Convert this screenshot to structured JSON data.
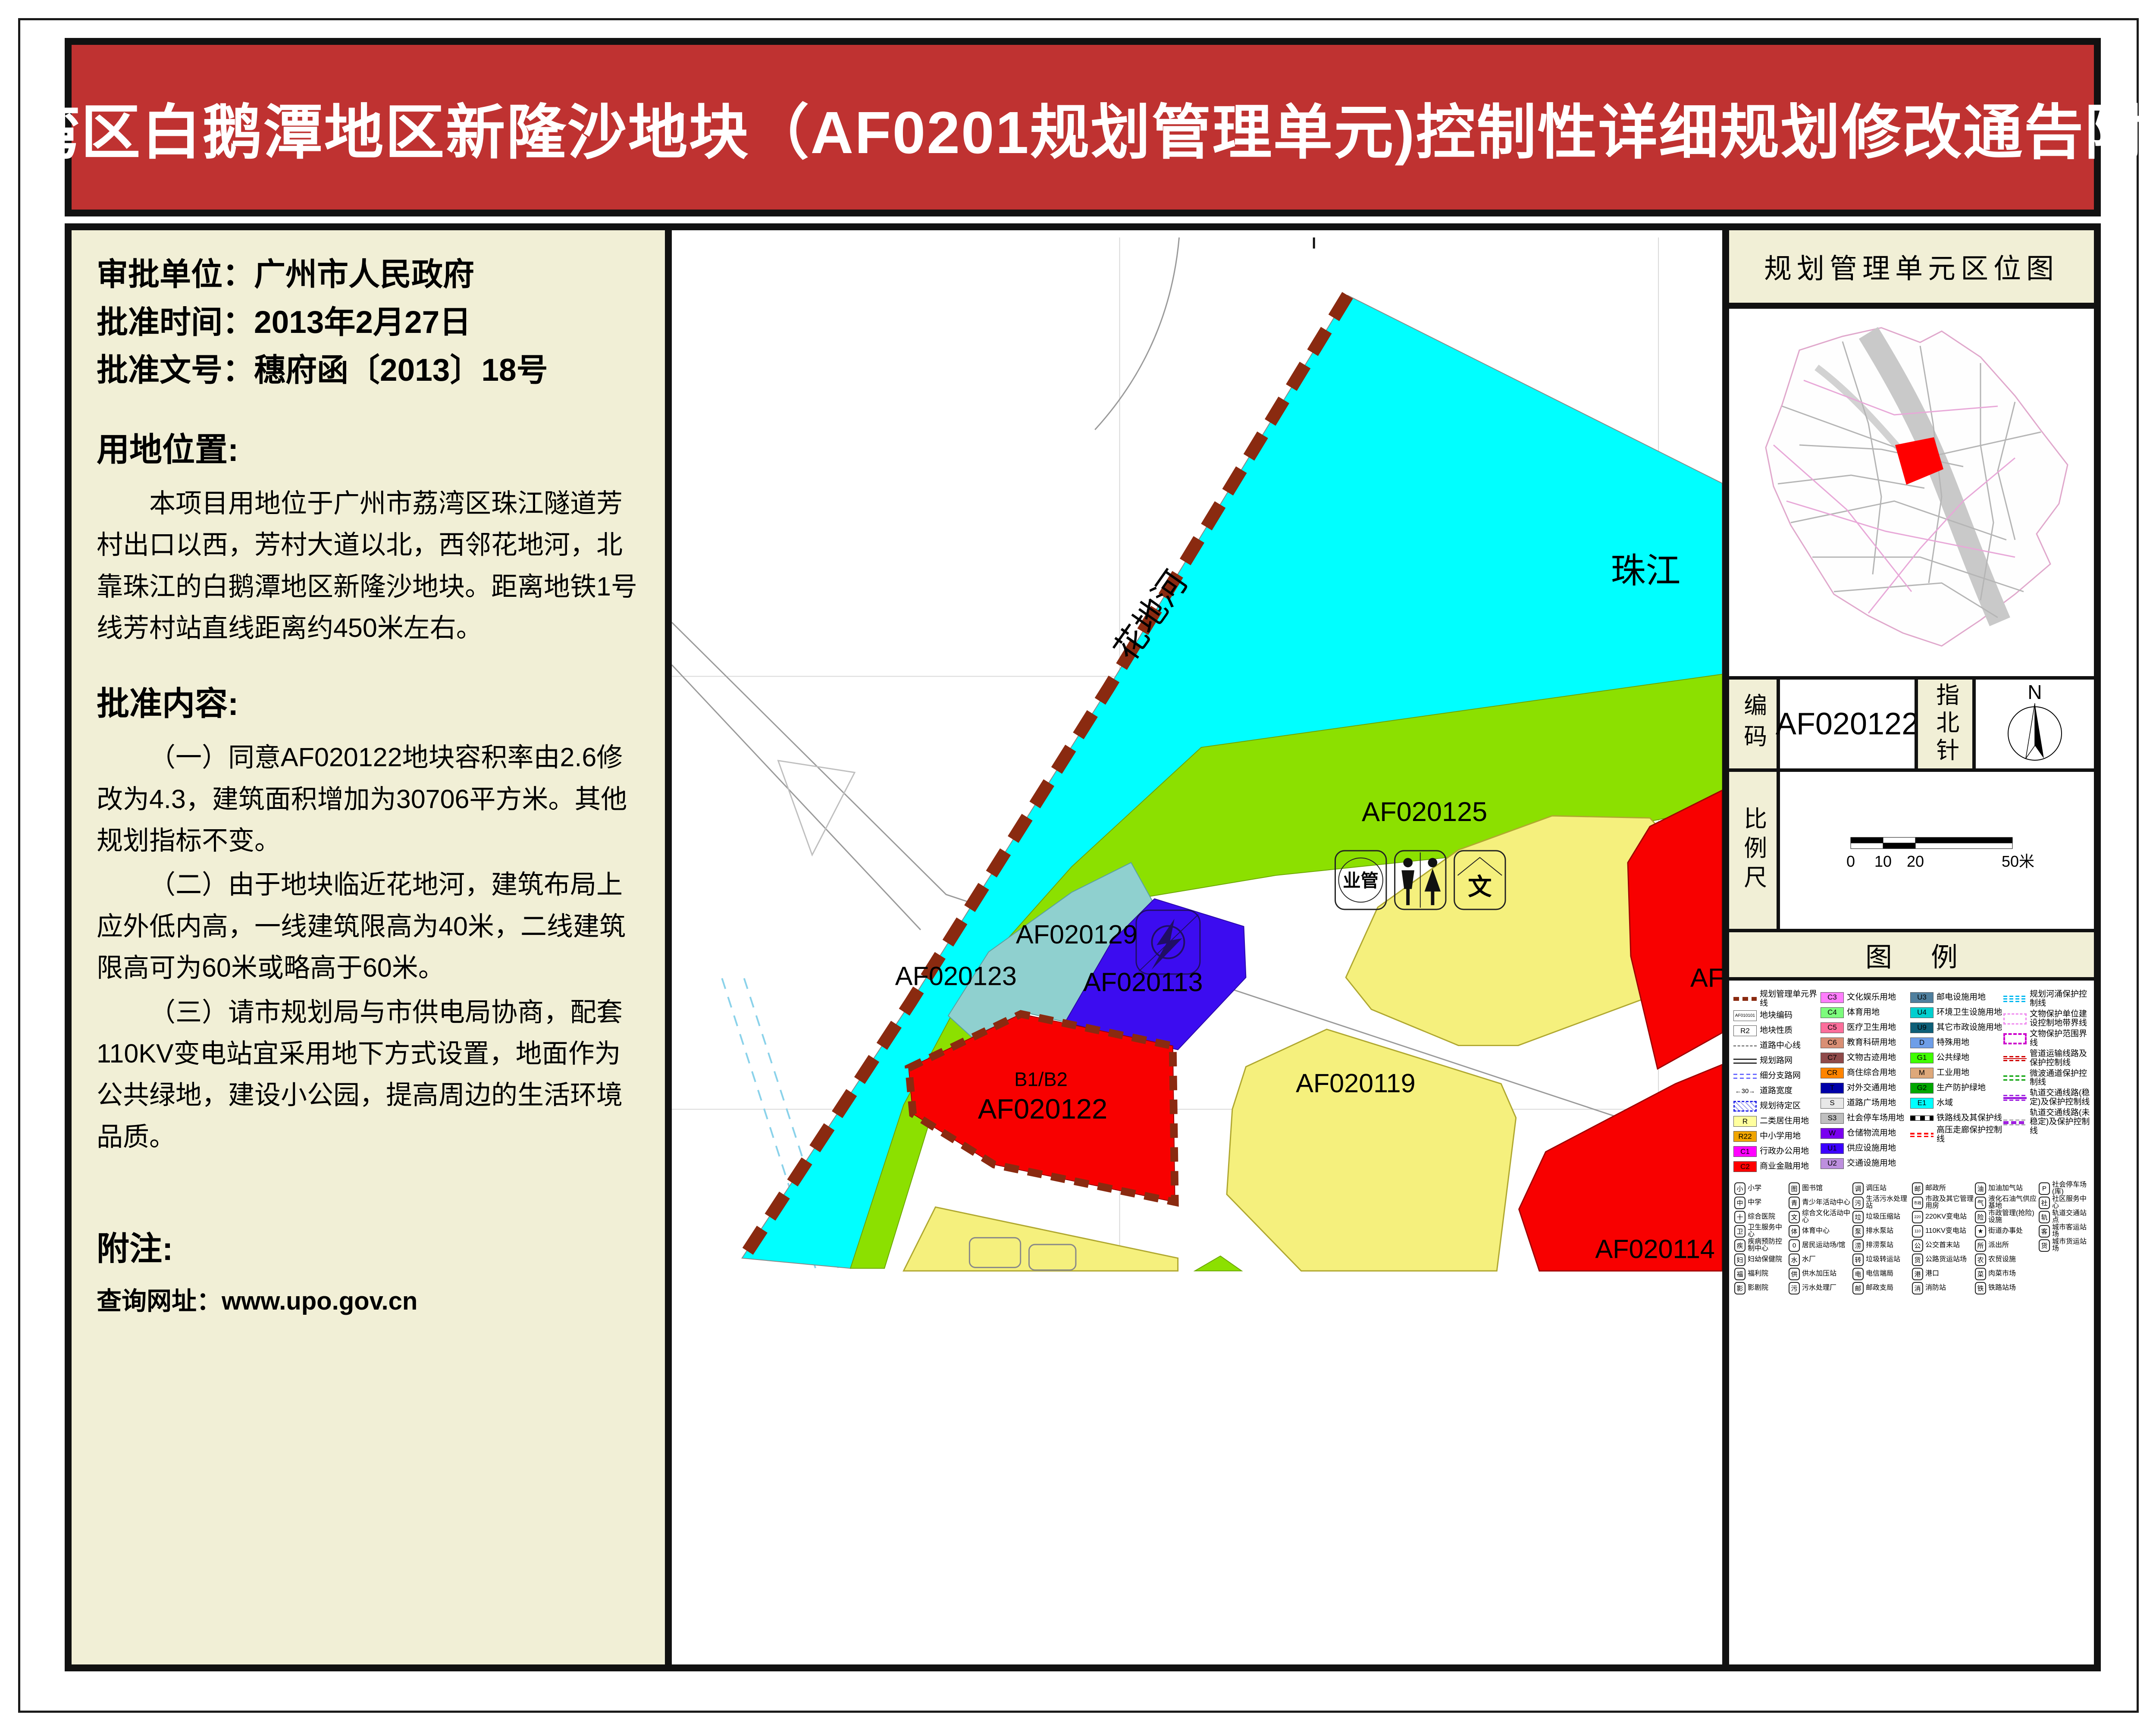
{
  "title": "荔湾区白鹅潭地区新隆沙地块（AF0201规划管理单元)控制性详细规划修改通告附图",
  "title_bg": "#bf3231",
  "info": {
    "approval_unit": "审批单位：广州市人民政府",
    "approval_date": "批准时间：2013年2月27日",
    "approval_doc": "批准文号：穗府函〔2013〕18号",
    "location_heading": "用地位置:",
    "location_text": "本项目用地位于广州市荔湾区珠江隧道芳村出口以西，芳村大道以北，西邻花地河，北靠珠江的白鹅潭地区新隆沙地块。距离地铁1号线芳村站直线距离约450米左右。",
    "content_heading": "批准内容:",
    "content_item1": "（一）同意AF020122地块容积率由2.6修改为4.3，建筑面积增加为30706平方米。其他规划指标不变。",
    "content_item2": "（二）由于地块临近花地河，建筑布局上应外低内高，一线建筑限高为40米，二线建筑限高可为60米或略高于60米。",
    "content_item3": "（三）请市规划局与市供电局协商，配套110KV变电站宜采用地下方式设置，地面作为公共绿地，建设小公园，提高周边的生活环境品质。",
    "note_heading": "附注:",
    "note_url": "查询网址：www.upo.gov.cn"
  },
  "map": {
    "colors": {
      "water": "#00ffff",
      "green": "#8ce000",
      "yellow": "#f5f07d",
      "red": "#f80000",
      "teal": "#8fd0cf",
      "blue": "#3c0cf0",
      "boundary": "#8a2a10"
    },
    "labels": {
      "river_main": "珠江",
      "river_side": "花地河",
      "p125": "AF020125",
      "p129": "AF020129",
      "p123": "AF020123",
      "p113": "AF020113",
      "p119": "AF020119",
      "p122_sub": "B1/B2",
      "p122": "AF020122",
      "p114": "AF020114",
      "p_edge": "AF0",
      "icon_mgmt": "业管",
      "icon_culture": "文"
    }
  },
  "side": {
    "locmap_title": "规划管理单元区位图",
    "code_label": "编码",
    "code_value": "AF020122",
    "compass_label": "指北针",
    "compass_n": "N",
    "scale_label": "比例尺",
    "scale_ticks": {
      "t0": "0",
      "t10": "10",
      "t20": "20",
      "t50": "50米"
    },
    "legend_title": "图例",
    "landuse_cols": [
      [
        {
          "label": "规划管理单元界线"
        },
        {
          "code": "AF010101",
          "label": "地块编码"
        },
        {
          "code": "R2",
          "label": "地块性质"
        },
        {
          "label": "道路中心线"
        },
        {
          "label": "规划路网"
        },
        {
          "label": "细分支路网"
        },
        {
          "code": "←30→",
          "label": "道路宽度"
        },
        {
          "label": "规划待定区"
        },
        {
          "code": "R",
          "color": "#ffff9e",
          "label": "二类居住用地"
        },
        {
          "code": "R22",
          "color": "#f0a500",
          "label": "中小学用地"
        },
        {
          "code": "C1",
          "color": "#ff00ff",
          "label": "行政办公用地"
        },
        {
          "code": "C2",
          "color": "#ff0000",
          "label": "商业金融用地"
        }
      ],
      [
        {
          "code": "C3",
          "color": "#ff7dfc",
          "label": "文化娱乐用地"
        },
        {
          "code": "C4",
          "color": "#7dfc7d",
          "label": "体育用地"
        },
        {
          "code": "C5",
          "color": "#fc6e9b",
          "label": "医疗卫生用地"
        },
        {
          "code": "C6",
          "color": "#d98f74",
          "label": "教育科研用地"
        },
        {
          "code": "C7",
          "color": "#8f4a4a",
          "label": "文物古迹用地"
        },
        {
          "code": "CR",
          "color": "#ff8400",
          "label": "商住综合用地"
        },
        {
          "code": "T",
          "color": "#0000a8",
          "label": "对外交通用地"
        },
        {
          "code": "S",
          "color": "#e8e8e8",
          "label": "道路广场用地"
        },
        {
          "code": "S3",
          "color": "#bfbfbf",
          "label": "社会停车场用地"
        },
        {
          "code": "W",
          "color": "#7a00f0",
          "label": "仓储物流用地"
        },
        {
          "code": "U1",
          "color": "#3c00ff",
          "label": "供应设施用地"
        },
        {
          "code": "U2",
          "color": "#bd8fde",
          "label": "交通设施用地"
        }
      ],
      [
        {
          "code": "U3",
          "color": "#4f7f9e",
          "label": "邮电设施用地"
        },
        {
          "code": "U4",
          "color": "#00cfcf",
          "label": "环境卫生设施用地"
        },
        {
          "code": "U9",
          "color": "#0e5f78",
          "label": "其它市政设施用地"
        },
        {
          "code": "D",
          "color": "#6e9ee8",
          "label": "特殊用地"
        },
        {
          "code": "G1",
          "color": "#3fff00",
          "label": "公共绿地"
        },
        {
          "code": "M",
          "color": "#dea87a",
          "label": "工业用地"
        },
        {
          "code": "G2",
          "color": "#00a800",
          "label": "生产防护绿地"
        },
        {
          "code": "E1",
          "color": "#00ffff",
          "label": "水域"
        },
        {
          "label": "铁路线及其保护线"
        },
        {
          "label": "高压走廊保护控制线"
        }
      ],
      [
        {
          "label": "规划河涌保护控制线"
        },
        {
          "label": "文物保护单位建设控制地带界线"
        },
        {
          "label": "文物保护范围界线"
        },
        {
          "label": "管道运输线路及保护控制线"
        },
        {
          "label": "微波通道保护控制线"
        },
        {
          "label": "轨道交通线路(稳定)及保护控制线"
        },
        {
          "label": "轨道交通线路(未稳定)及保护控制线"
        }
      ]
    ],
    "facility_cols": [
      [
        {
          "glyph": "小",
          "label": "小学"
        },
        {
          "glyph": "中",
          "label": "中学"
        },
        {
          "glyph": "十",
          "label": "综合医院"
        },
        {
          "glyph": "卫",
          "label": "卫生服务中心"
        },
        {
          "glyph": "疾",
          "label": "疾病预防控制中心"
        },
        {
          "glyph": "妇",
          "label": "妇幼保健院"
        },
        {
          "glyph": "福",
          "label": "福利院"
        },
        {
          "glyph": "影",
          "label": "影剧院"
        }
      ],
      [
        {
          "glyph": "图",
          "label": "图书馆"
        },
        {
          "glyph": "青",
          "label": "青少年活动中心"
        },
        {
          "glyph": "文",
          "label": "综合文化活动中心"
        },
        {
          "glyph": "体",
          "label": "体育中心"
        },
        {
          "glyph": "0",
          "label": "居民运动场/馆"
        },
        {
          "glyph": "水",
          "label": "水厂"
        },
        {
          "glyph": "供",
          "label": "供水加压站"
        },
        {
          "glyph": "污",
          "label": "污水处理厂"
        }
      ],
      [
        {
          "glyph": "调",
          "label": "调压站"
        },
        {
          "glyph": "污",
          "label": "生活污水处理站"
        },
        {
          "glyph": "垃",
          "label": "垃圾压缩站"
        },
        {
          "glyph": "泵",
          "label": "排水泵站"
        },
        {
          "glyph": "涝",
          "label": "排涝泵站"
        },
        {
          "glyph": "转",
          "label": "垃圾转运站"
        },
        {
          "glyph": "电",
          "label": "电信端局"
        },
        {
          "glyph": "邮",
          "label": "邮政支局"
        }
      ],
      [
        {
          "glyph": "邮",
          "label": "邮政所"
        },
        {
          "glyph": "市政",
          "label": "市政及其它管理用房"
        },
        {
          "glyph": "220",
          "label": "220KV变电站"
        },
        {
          "glyph": "110",
          "label": "110KV变电站"
        },
        {
          "glyph": "公",
          "label": "公交首末站"
        },
        {
          "glyph": "货",
          "label": "公路货运站场"
        },
        {
          "glyph": "港",
          "label": "港口"
        },
        {
          "glyph": "消",
          "label": "消防站"
        }
      ],
      [
        {
          "glyph": "油",
          "label": "加油加气站"
        },
        {
          "glyph": "气",
          "label": "液化石油气供应基地"
        },
        {
          "glyph": "险",
          "label": "市政管理(抢险)设施"
        },
        {
          "glyph": "★",
          "label": "街道办事处"
        },
        {
          "glyph": "所",
          "label": "派出所"
        },
        {
          "glyph": "农",
          "label": "农贸设施"
        },
        {
          "glyph": "菜",
          "label": "肉菜市场"
        },
        {
          "glyph": "铁",
          "label": "铁路站场"
        }
      ],
      [
        {
          "glyph": "P",
          "label": "社会停车场(库)"
        },
        {
          "glyph": "社",
          "label": "社区服务中心"
        },
        {
          "glyph": "轨",
          "label": "轨道交通站点"
        },
        {
          "glyph": "客",
          "label": "城市客运站场"
        },
        {
          "glyph": "货",
          "label": "城市货运站场"
        }
      ]
    ]
  }
}
